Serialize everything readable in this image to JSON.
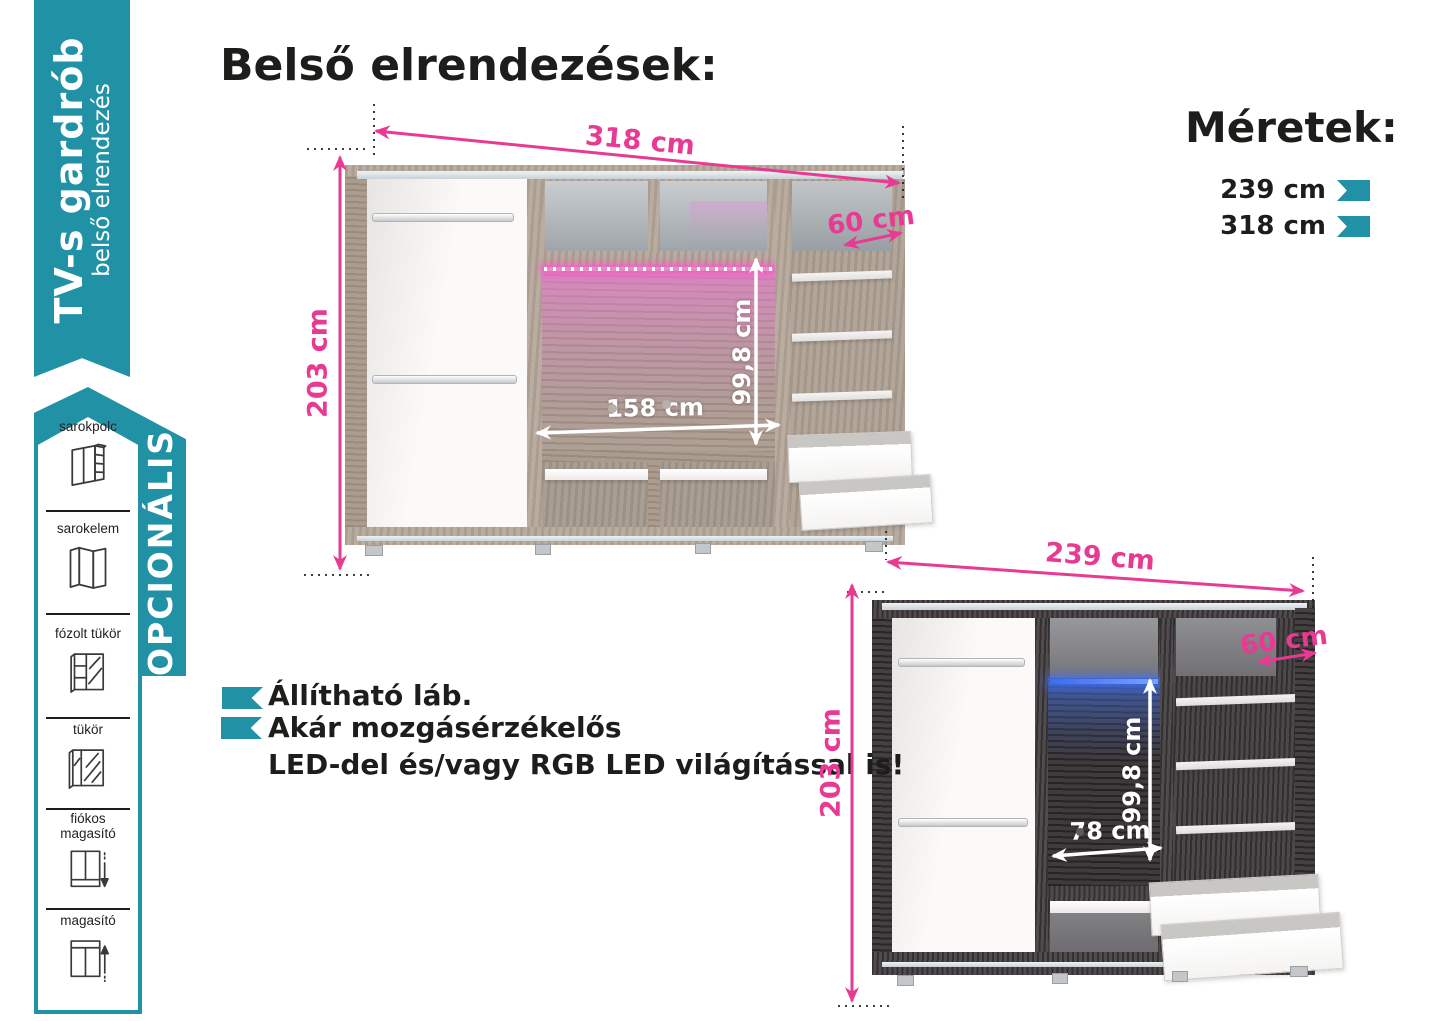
{
  "brand_ribbon": {
    "title": "TV-s gardrób",
    "subtitle": "belső elrendezés"
  },
  "optional_ribbon": {
    "label": "OPCIONÁLIS"
  },
  "options": [
    {
      "label": "sarokpolc"
    },
    {
      "label": "sarokelem"
    },
    {
      "label": "fózolt tükör"
    },
    {
      "label": "tükör"
    },
    {
      "label": "fiókos",
      "label2": "magasító"
    },
    {
      "label": "magasító"
    }
  ],
  "page_title": "Belső elrendezések:",
  "sizes": {
    "title": "Méretek:",
    "items": [
      {
        "label": "239 cm"
      },
      {
        "label": "318 cm"
      }
    ]
  },
  "features": {
    "bullet1": "Állítható láb.",
    "bullet2": "Akár mozgásérzékelős",
    "line2": "LED-del és/vagy RGB LED világítással is!"
  },
  "wardrobe_large": {
    "width": "318 cm",
    "height": "203 cm",
    "depth": "60 cm",
    "tv_height": "99,8 cm",
    "tv_width": "158 cm"
  },
  "wardrobe_small": {
    "width": "239 cm",
    "height": "203 cm",
    "depth": "60 cm",
    "tv_height": "99,8 cm",
    "tv_width": "78 cm"
  },
  "colors": {
    "teal": "#2191a6",
    "pink": "#e83a92",
    "text": "#1d1d1b"
  }
}
